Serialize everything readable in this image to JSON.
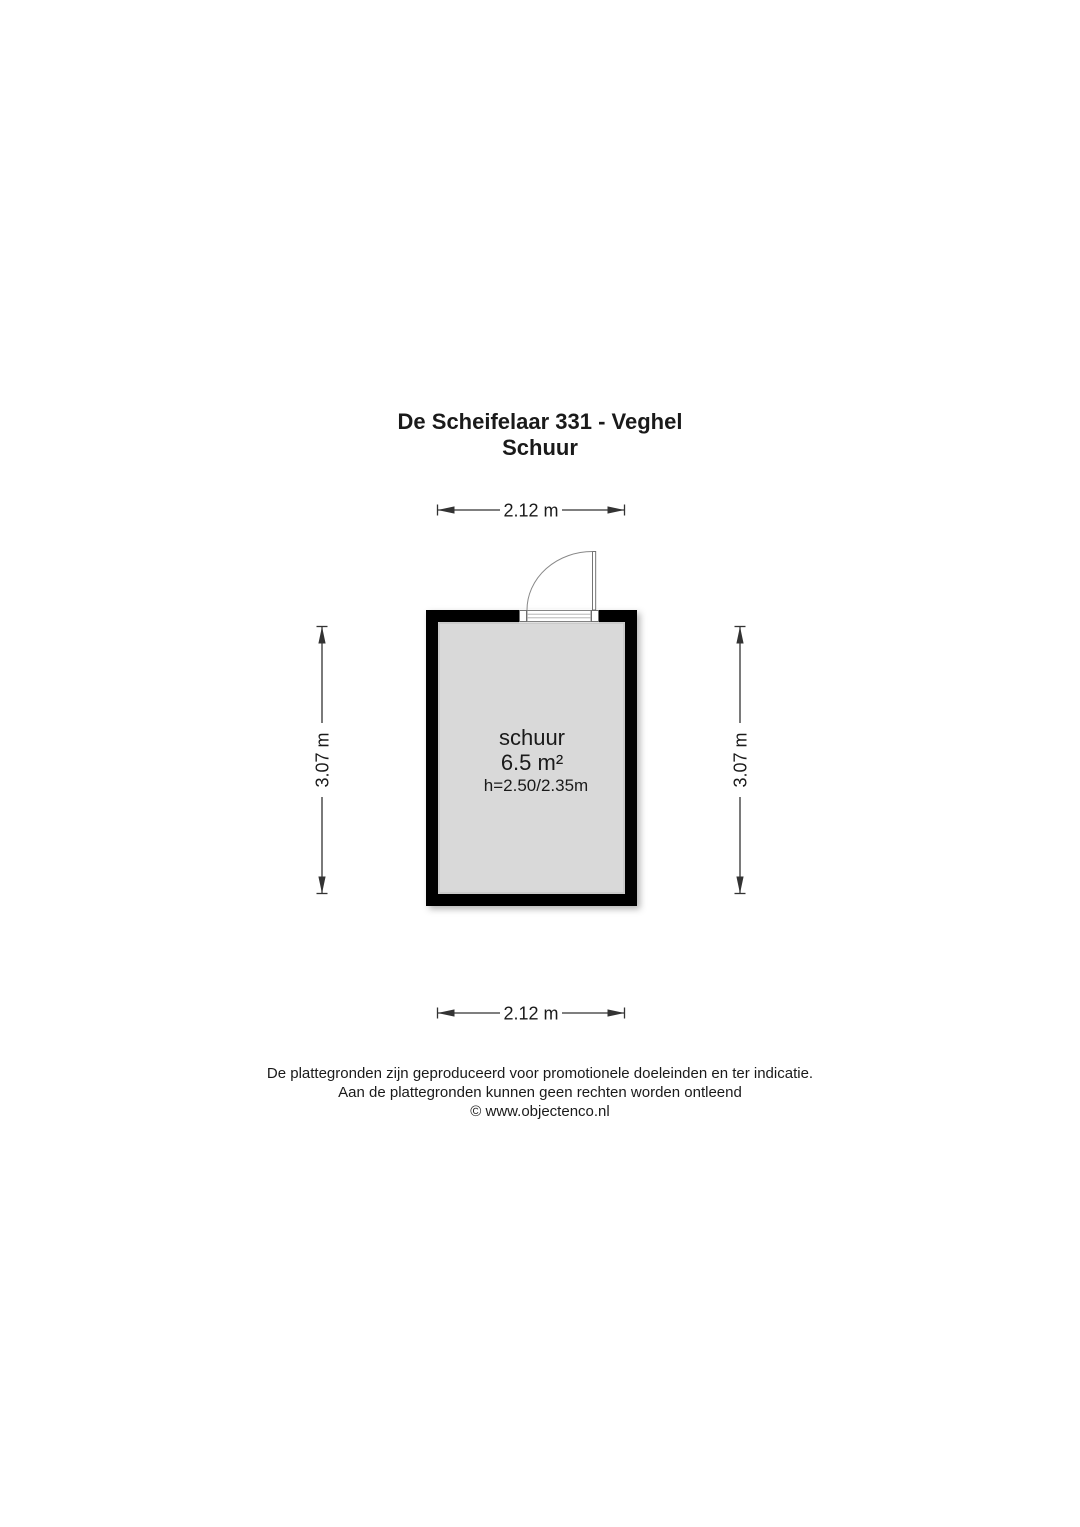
{
  "title": {
    "address": "De Scheifelaar 331 - Veghel",
    "subtitle": "Schuur"
  },
  "room": {
    "name": "schuur",
    "area": "6.5 m²",
    "ceiling_height": "h=2.50/2.35m"
  },
  "dimensions": {
    "width_top": "2.12 m",
    "width_bottom": "2.12 m",
    "height_left": "3.07 m",
    "height_right": "3.07 m"
  },
  "footer": {
    "line1": "De plattegronden zijn geproduceerd voor promotionele doeleinden en ter indicatie.",
    "line2": "Aan de plattegronden kunnen geen rechten worden ontleend",
    "line3": "© www.objectenco.nl"
  },
  "colors": {
    "wall": "#000000",
    "floor": "#d9d9d9",
    "text": "#1a1a1a",
    "dimension_line": "#333333",
    "background": "#ffffff"
  }
}
